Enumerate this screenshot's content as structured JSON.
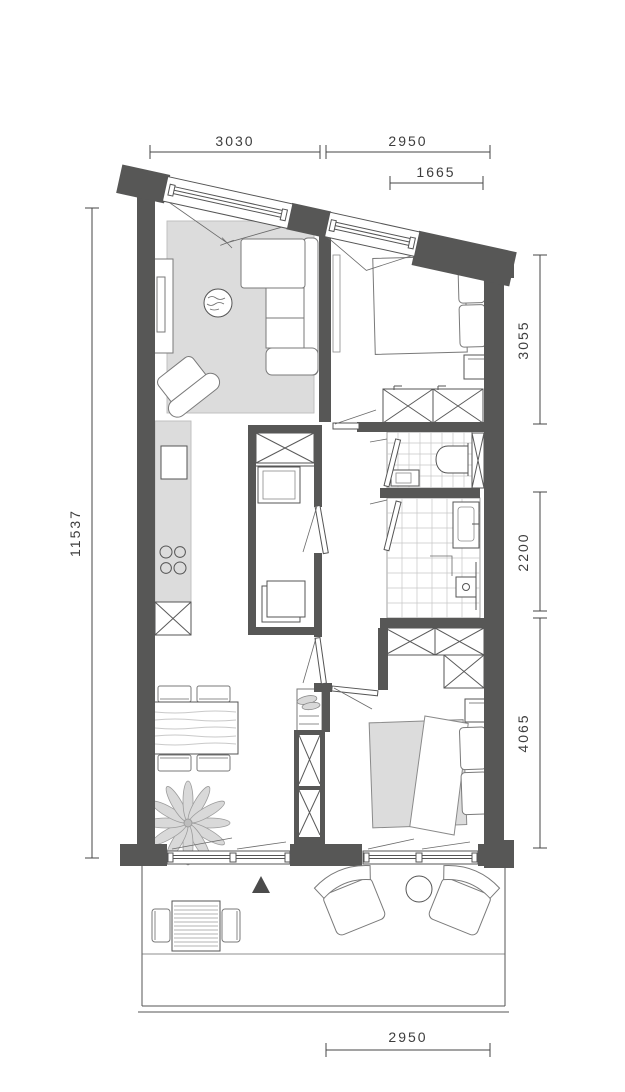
{
  "dimensions": {
    "top_left": "3030",
    "top_right": "2950",
    "window": "1665",
    "left": "11537",
    "right_top": "3055",
    "right_middle": "2200",
    "right_bottom": "4065",
    "bottom": "2950"
  },
  "colors": {
    "wall": "#575756",
    "fill_soft": "#dcdcdc",
    "arrow": "#4b4b4b",
    "dim_text": "#3d3d3d",
    "background": "#ffffff"
  }
}
